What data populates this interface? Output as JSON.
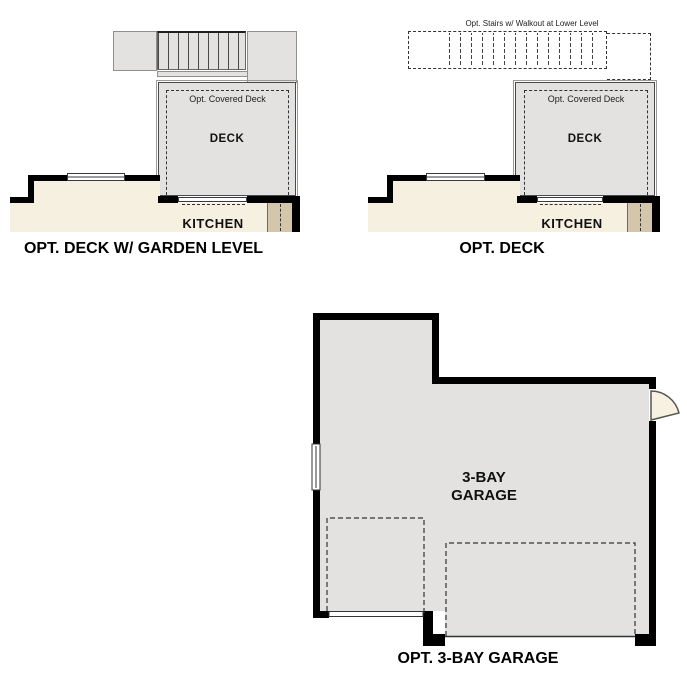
{
  "colors": {
    "wall": "#000000",
    "floor_gray": "#e3e2e0",
    "kitchen_cream": "#f6f0e1",
    "cabinet_tan": "#d3c6aa",
    "plan_line": "#444444",
    "door_leaf_cream": "#f8f1e2"
  },
  "diagram_deck_garden": {
    "title": "OPT. DECK W/ GARDEN LEVEL",
    "covered_deck_label": "Opt. Covered Deck",
    "deck_label": "DECK",
    "kitchen_label": "KITCHEN"
  },
  "diagram_deck": {
    "title": "OPT. DECK",
    "stairs_label": "Opt. Stairs w/ Walkout at Lower Level",
    "covered_deck_label": "Opt. Covered Deck",
    "deck_label": "DECK",
    "kitchen_label": "KITCHEN"
  },
  "diagram_garage": {
    "title": "OPT. 3-BAY GARAGE",
    "label_line1": "3-BAY",
    "label_line2": "GARAGE"
  }
}
